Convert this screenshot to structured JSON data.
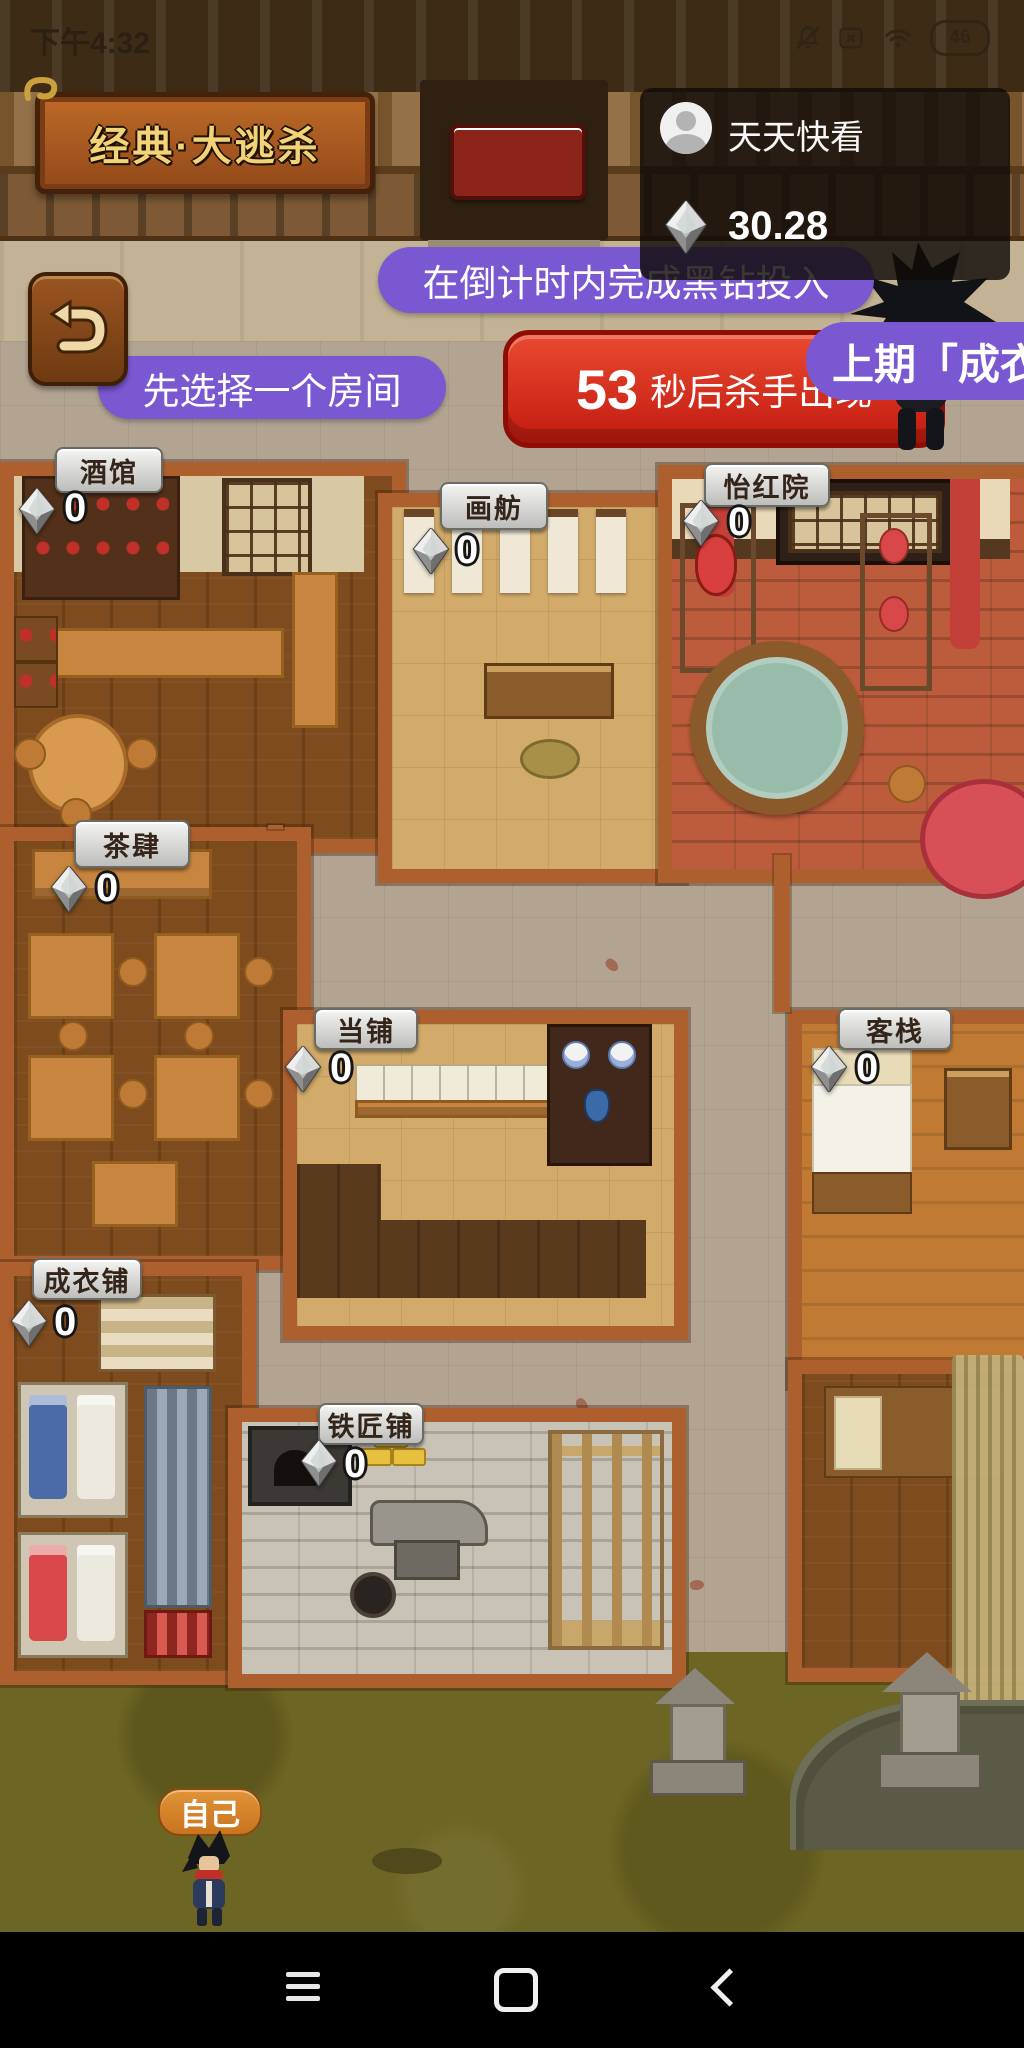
{
  "status_bar": {
    "time": "下午4:32",
    "battery_level": "46",
    "icons": {
      "mute": "mute-icon",
      "no_sim": "no-sim-icon",
      "wifi": "wifi-icon",
      "battery": "battery-icon"
    }
  },
  "header": {
    "mode_title": "经典·大逃杀",
    "player": {
      "name": "天天快看",
      "balance": "30.28",
      "currency_icon": "diamond-icon"
    }
  },
  "hud": {
    "tip_countdown": "在倒计时内完成黑钻投入",
    "tip_select_room": "先选择一个房间",
    "killer_timer": {
      "seconds": "53",
      "label": "秒后杀手出现"
    },
    "last_round": "上期「成衣铺",
    "self_marker": "自己",
    "back_icon": "back-arrow-icon",
    "killer_icon": "ninja-silhouette"
  },
  "rooms": [
    {
      "name": "酒馆",
      "stake": "0"
    },
    {
      "name": "画舫",
      "stake": "0"
    },
    {
      "name": "怡红院",
      "stake": "0"
    },
    {
      "name": "茶肆",
      "stake": "0"
    },
    {
      "name": "当铺",
      "stake": "0"
    },
    {
      "name": "客栈",
      "stake": "0"
    },
    {
      "name": "成衣铺",
      "stake": "0"
    },
    {
      "name": "铁匠铺",
      "stake": "0"
    }
  ],
  "colors": {
    "hint_purple": "#7a58d2",
    "timer_red": "#d8251b",
    "title_plaque_bg": "#a85a22",
    "title_text_gold": "#f3d377",
    "self_marker_orange": "#d9862f",
    "room_wall": "#ad5f2d"
  },
  "nav_bar": {
    "icons": [
      "menu-icon",
      "home-icon",
      "back-icon"
    ]
  }
}
